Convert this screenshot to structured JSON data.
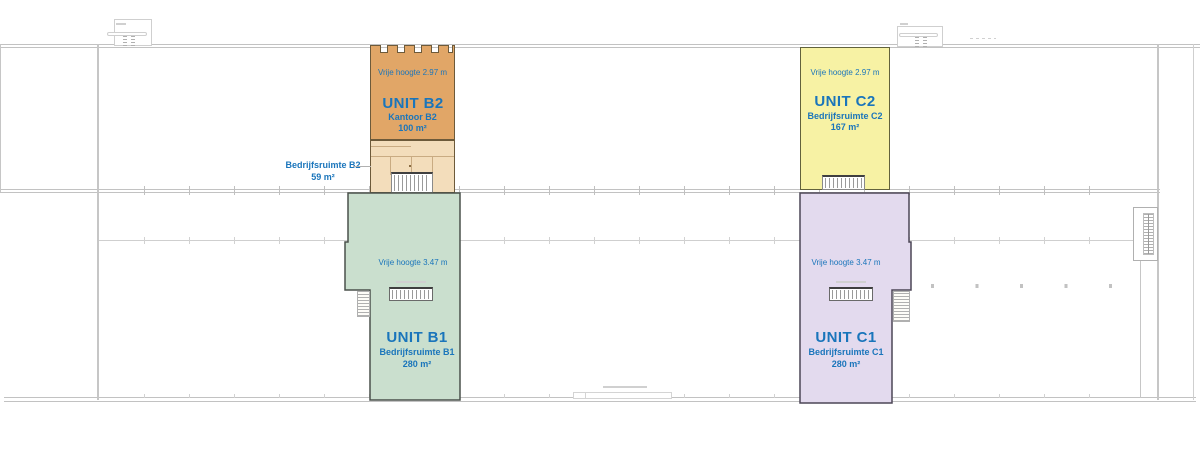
{
  "plan": {
    "text_color": "#1a75bb",
    "units": {
      "b2": {
        "height_note": "Vrije hoogte 2.97 m",
        "title": "UNIT B2",
        "subtitle": "Kantoor B2",
        "area": "100 m²",
        "fill": "#e1a667"
      },
      "c2": {
        "height_note": "Vrije hoogte 2.97 m",
        "title": "UNIT C2",
        "subtitle": "Bedrijfsruimte C2",
        "area": "167 m²",
        "fill": "#f7f2a4"
      },
      "b1": {
        "height_note": "Vrije hoogte 3.47 m",
        "title": "UNIT B1",
        "subtitle": "Bedrijfsruimte B1",
        "area": "280 m²",
        "fill": "#cadfce"
      },
      "c1": {
        "height_note": "Vrije hoogte 3.47 m",
        "title": "UNIT C1",
        "subtitle": "Bedrijfsruimte C1",
        "area": "280 m²",
        "fill": "#e3daee"
      }
    },
    "annex_label": {
      "name": "Bedrijfsruimte B2",
      "area": "59 m²",
      "fill": "#f3ddbb"
    }
  }
}
